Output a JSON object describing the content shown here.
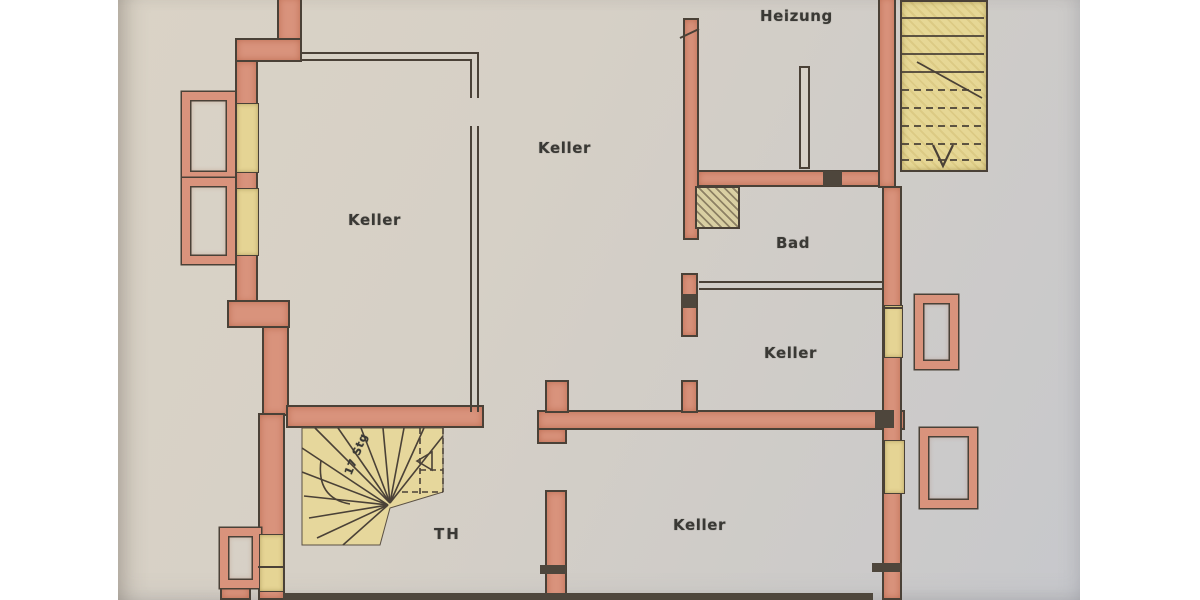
{
  "labels": {
    "heizung": "Heizung",
    "keller_top": "Keller",
    "keller_left": "Keller",
    "bad": "Bad",
    "keller_mid": "Keller",
    "keller_bottom": "Keller",
    "th": "TH",
    "stair_note": "17 Stg"
  },
  "colors": {
    "paper": "#d6cfc5",
    "wall_fill": "#d9937c",
    "wall_outline": "#4a4137",
    "window_fill": "#e5d494",
    "label_text": "#3a3935",
    "dark_block": "#4e463c",
    "page_background": "#ffffff"
  }
}
